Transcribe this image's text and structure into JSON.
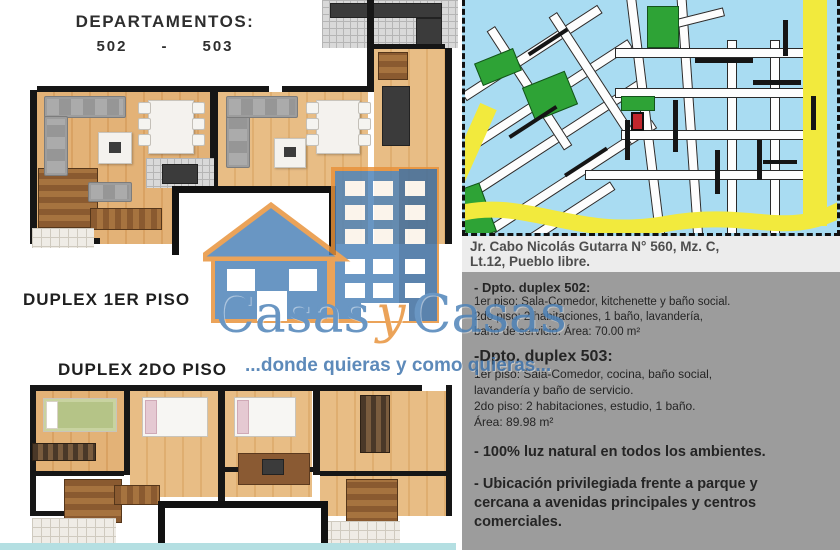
{
  "header": {
    "title": "DEPARTAMENTOS:",
    "unit_left": "502",
    "dash": "-",
    "unit_right": "503"
  },
  "floorplans": {
    "duplex1_label": "DUPLEX 1ER PISO",
    "duplex2_label": "DUPLEX 2DO PISO"
  },
  "map": {
    "water_color": "#a9dcf2",
    "park_color": "#2ea336",
    "road_color": "#f2ea3d",
    "marker_color": "#c1272d"
  },
  "address": {
    "line1": "Jr. Cabo Nicolás Gutarra N° 560, Mz. C,",
    "line2": "Lt.12, Pueblo libre."
  },
  "details": {
    "apt502": {
      "title": "- Dpto. duplex 502:",
      "line1": "1er piso: Sala-Comedor, kitchenette y baño social.",
      "line2": "2do piso: 2 habitaciones, 1 baño, lavandería,",
      "line3": "baño de servicio. Área: 70.00 m²"
    },
    "apt503": {
      "title": "-Dpto. duplex 503:",
      "line1": "1er piso: Sala-Comedor, cocina, baño social,",
      "line2": "lavandería y baño de servicio.",
      "line3": "2do piso: 2 habitaciones, estudio, 1 baño.",
      "line4": "Área: 89.98 m²"
    },
    "feature1": "- 100% luz natural en todos los ambientes.",
    "feature2_line1": "- Ubicación privilegiada frente a parque y",
    "feature2_line2": "cercana a avenidas principales y centros",
    "feature2_line3": "comerciales."
  },
  "logo": {
    "word1": "Casas",
    "conj": "y",
    "word2": "Casas",
    "tagline": "...donde quieras y como quieras...",
    "brand_blue": "#4d82b8",
    "brand_orange": "#e8923a"
  }
}
